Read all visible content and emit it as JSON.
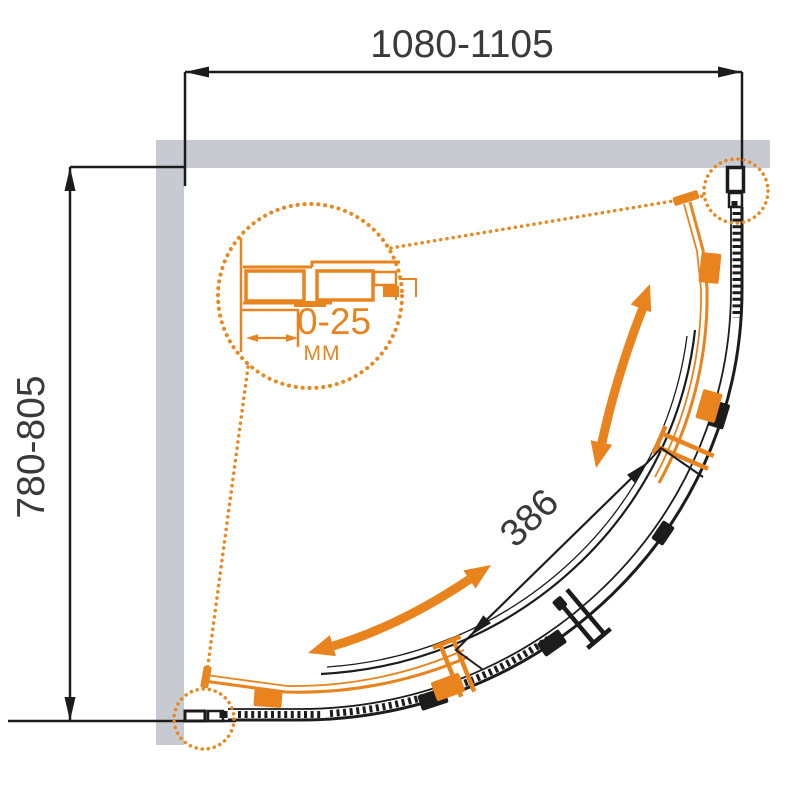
{
  "drawing": {
    "type": "shower-enclosure-quadrant-plan",
    "labels": {
      "width_range": "1080-1105",
      "depth_range": "780-805",
      "door_opening": "386",
      "adjustment_range": "0-25",
      "adjustment_unit": "MM"
    },
    "colors": {
      "accent_orange": "#E8831D",
      "dot_orange": "#E8881E",
      "wall_gray": "#C7CBD1",
      "line_black": "#1C1C1C",
      "dim_text": "#3A3A3A",
      "background": "#FFFFFF"
    }
  }
}
